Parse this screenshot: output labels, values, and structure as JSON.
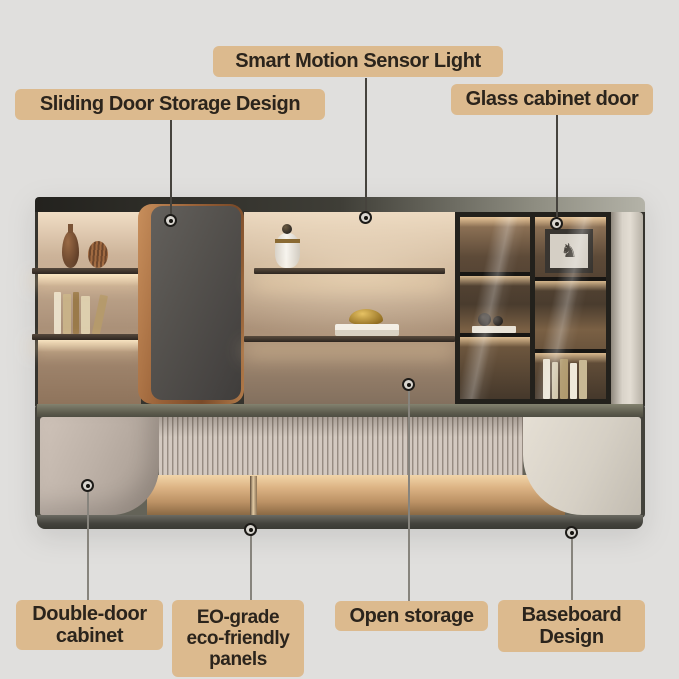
{
  "meta": {
    "type": "product-feature-diagram",
    "subject": "modern wall storage cabinet with annotated features"
  },
  "colors": {
    "page_bg": "#e0dfdd",
    "label_bg": "#dcba8e",
    "label_text": "#2b241c",
    "connector_line_dark": "#46433d",
    "connector_line_light": "#87847d",
    "cabinet_frame": "#35332d",
    "warm_backlight": "#f2d5a8",
    "copper_accent": "#b27b4a",
    "sliding_door": "#55524e",
    "base_door_panel": "#bdb1a7",
    "cream_panel": "#d6d0c5"
  },
  "icons": {
    "marker": "target-dot-icon",
    "picture": "horse-icon"
  },
  "decor": {
    "horse_glyph": "♞"
  },
  "callouts": {
    "smart_motion_sensor_light": {
      "label": "Smart Motion Sensor Light"
    },
    "sliding_door_storage": {
      "label": "Sliding Door Storage Design"
    },
    "glass_cabinet_door": {
      "label": "Glass cabinet door"
    },
    "double_door_cabinet": {
      "label": "Double-door cabinet"
    },
    "eo_grade_panels": {
      "label": "EO-grade eco-friendly panels"
    },
    "open_storage": {
      "label": "Open storage"
    },
    "baseboard_design": {
      "label": "Baseboard Design"
    }
  }
}
